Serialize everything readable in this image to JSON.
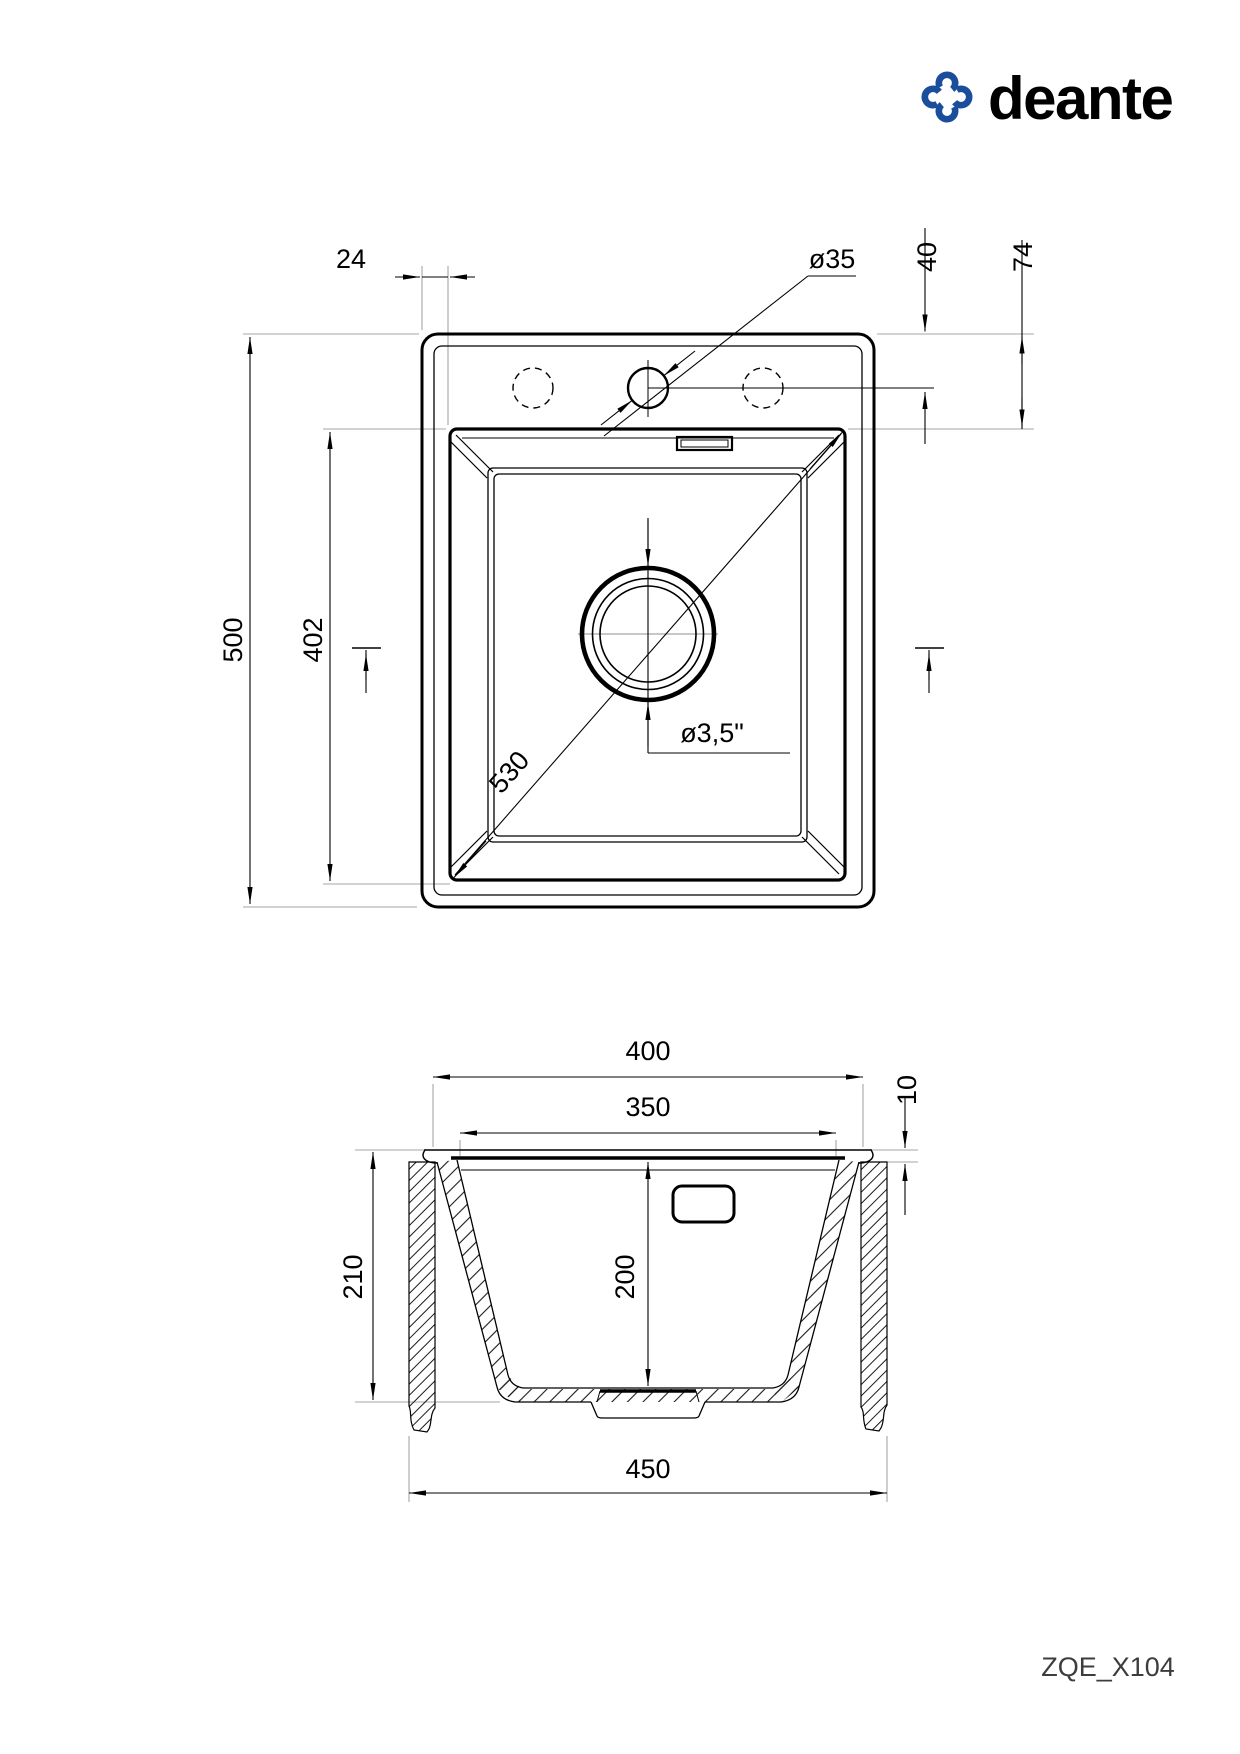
{
  "brand": {
    "logo_text": "deante"
  },
  "drawing": {
    "code": "ZQE_X104",
    "plan_view": {
      "rim_offset": "24",
      "tap_hole_diameter": "ø35",
      "tap_hole_center_offset": "40",
      "bowl_top_offset": "74",
      "overall_length": "500",
      "bowl_length": "402",
      "bowl_diagonal": "530",
      "drain_diameter": "ø3,5\""
    },
    "section_view": {
      "overall_width": "400",
      "bowl_width": "350",
      "rim_height": "10",
      "overall_depth": "210",
      "bowl_depth": "200",
      "min_cabinet_width": "450"
    }
  }
}
